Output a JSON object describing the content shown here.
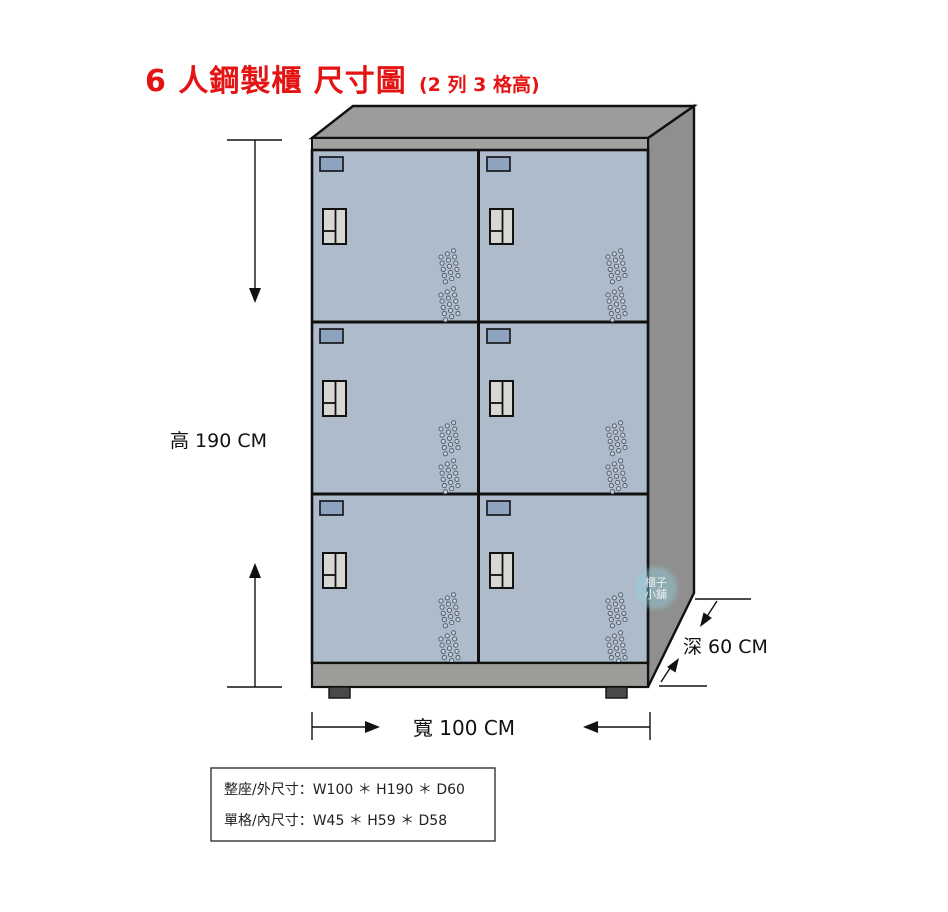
{
  "title": {
    "main": "6 人鋼製櫃 尺寸圖",
    "suffix": "(2 列 3 格高)"
  },
  "labels": {
    "height": "高 190 CM",
    "width": "寬 100 CM",
    "depth": "深 60 CM"
  },
  "spec_box": {
    "line1": "整座/外尺寸：W100 ＊ H190 ＊ D60",
    "line2": "單格/內尺寸：W45 ＊ H59 ＊ D58"
  },
  "watermark": {
    "line1": "櫃子",
    "line2": "小舖"
  },
  "cabinet": {
    "rows": 3,
    "columns": 2,
    "door_count": 6
  },
  "colors": {
    "title_red": "#e51414",
    "door_blue_gray": "#aebbca",
    "tag_blue": "#8da3bf",
    "handle_gray": "#d8d8d3",
    "top_gray": "#9c9c9c",
    "fascia_gray": "#a2a2a0",
    "side_gray": "#8f8f8f",
    "base_gray": "#9c9c98",
    "foot_dark": "#4a4a4a",
    "vent_fill": "#c5cfdb",
    "watermark_teal": "#8fd4e4"
  }
}
